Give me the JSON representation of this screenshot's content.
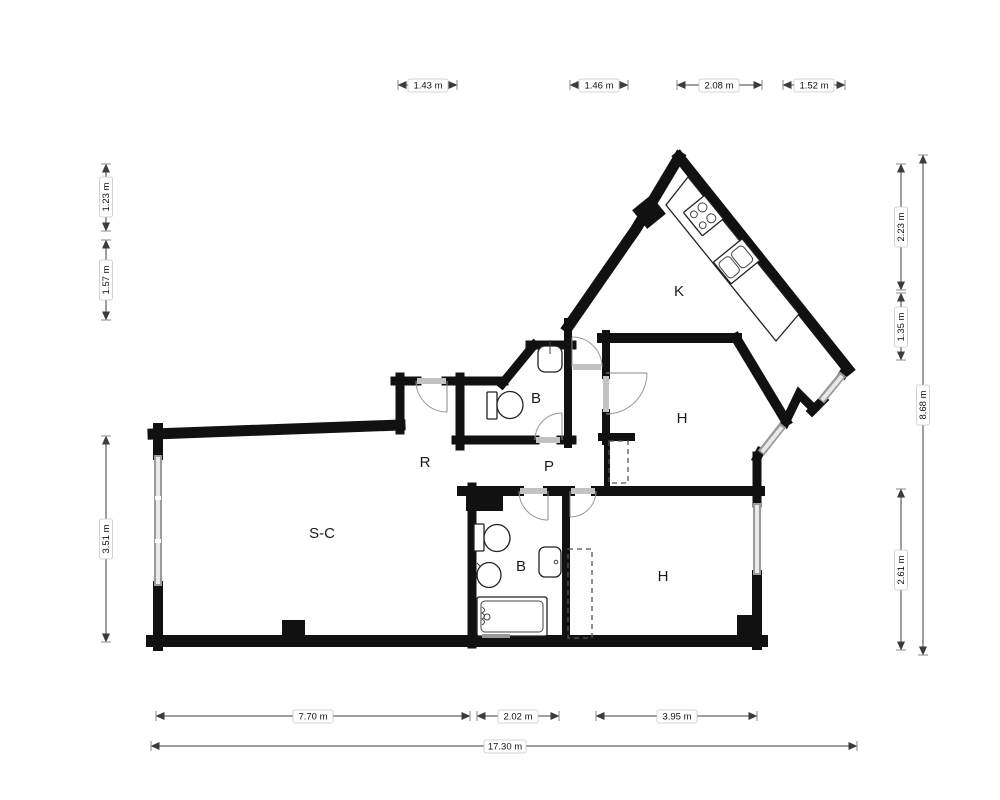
{
  "title": "apartment-floor-plan",
  "rooms": [
    {
      "id": "kitchen",
      "label": "K"
    },
    {
      "id": "bathroom-upper",
      "label": "B"
    },
    {
      "id": "bedroom-upper",
      "label": "H"
    },
    {
      "id": "entry-hall",
      "label": "R"
    },
    {
      "id": "corridor",
      "label": "P"
    },
    {
      "id": "living-dining",
      "label": "S-C"
    },
    {
      "id": "bathroom-lower",
      "label": "B"
    },
    {
      "id": "bedroom-lower",
      "label": "H"
    }
  ],
  "dimensions": {
    "top": [
      {
        "label": "1.43 m"
      },
      {
        "label": "1.46 m"
      },
      {
        "label": "2.08 m"
      },
      {
        "label": "1.52 m"
      }
    ],
    "left": [
      {
        "label": "1.23 m"
      },
      {
        "label": "1.57 m"
      },
      {
        "label": "3.51 m"
      }
    ],
    "right": [
      {
        "label": "2.23 m"
      },
      {
        "label": "1.35 m"
      },
      {
        "label": "2.61 m"
      },
      {
        "label": "8.68 m"
      }
    ],
    "bottom": [
      {
        "label": "7.70 m"
      },
      {
        "label": "2.02 m"
      },
      {
        "label": "3.95 m"
      },
      {
        "label": "17.30 m"
      }
    ]
  },
  "fixtures": [
    "stove-icon",
    "kitchen-sink-icon",
    "kitchen-counter",
    "toilet-icon",
    "washbasin-icon",
    "toilet-icon",
    "bidet-icon",
    "washbasin-icon",
    "bathtub-icon",
    "wardrobe-closet",
    "wardrobe-closet"
  ],
  "colors": {
    "wall": "#111111",
    "window": "#9a9a9a",
    "door_arc": "#999999",
    "dimension_line": "#3c3c3c",
    "background": "#ffffff"
  }
}
